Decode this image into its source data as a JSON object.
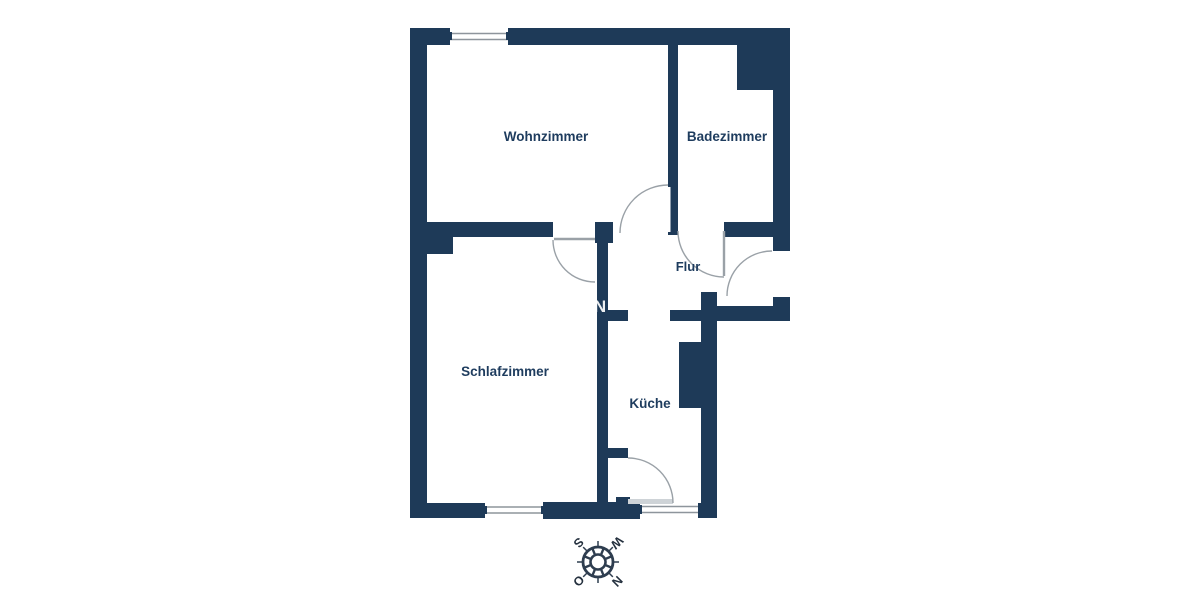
{
  "floorplan": {
    "rooms": [
      {
        "id": "wohnzimmer",
        "label": "Wohnzimmer"
      },
      {
        "id": "badezimmer",
        "label": "Badezimmer"
      },
      {
        "id": "flur",
        "label": "Flur"
      },
      {
        "id": "schlafzimmer",
        "label": "Schlafzimmer"
      },
      {
        "id": "kueche",
        "label": "Küche"
      }
    ],
    "watermark_letter": "N",
    "colors": {
      "wall": "#1e3a58",
      "label_text": "#1e3c5e",
      "door_arc": "#9aa1a7",
      "window_line": "#8e959c",
      "background": "#ffffff"
    }
  },
  "compass": {
    "north_label": "N",
    "east_label": "O",
    "south_label": "S",
    "west_label": "W",
    "rotation_deg": 135
  }
}
